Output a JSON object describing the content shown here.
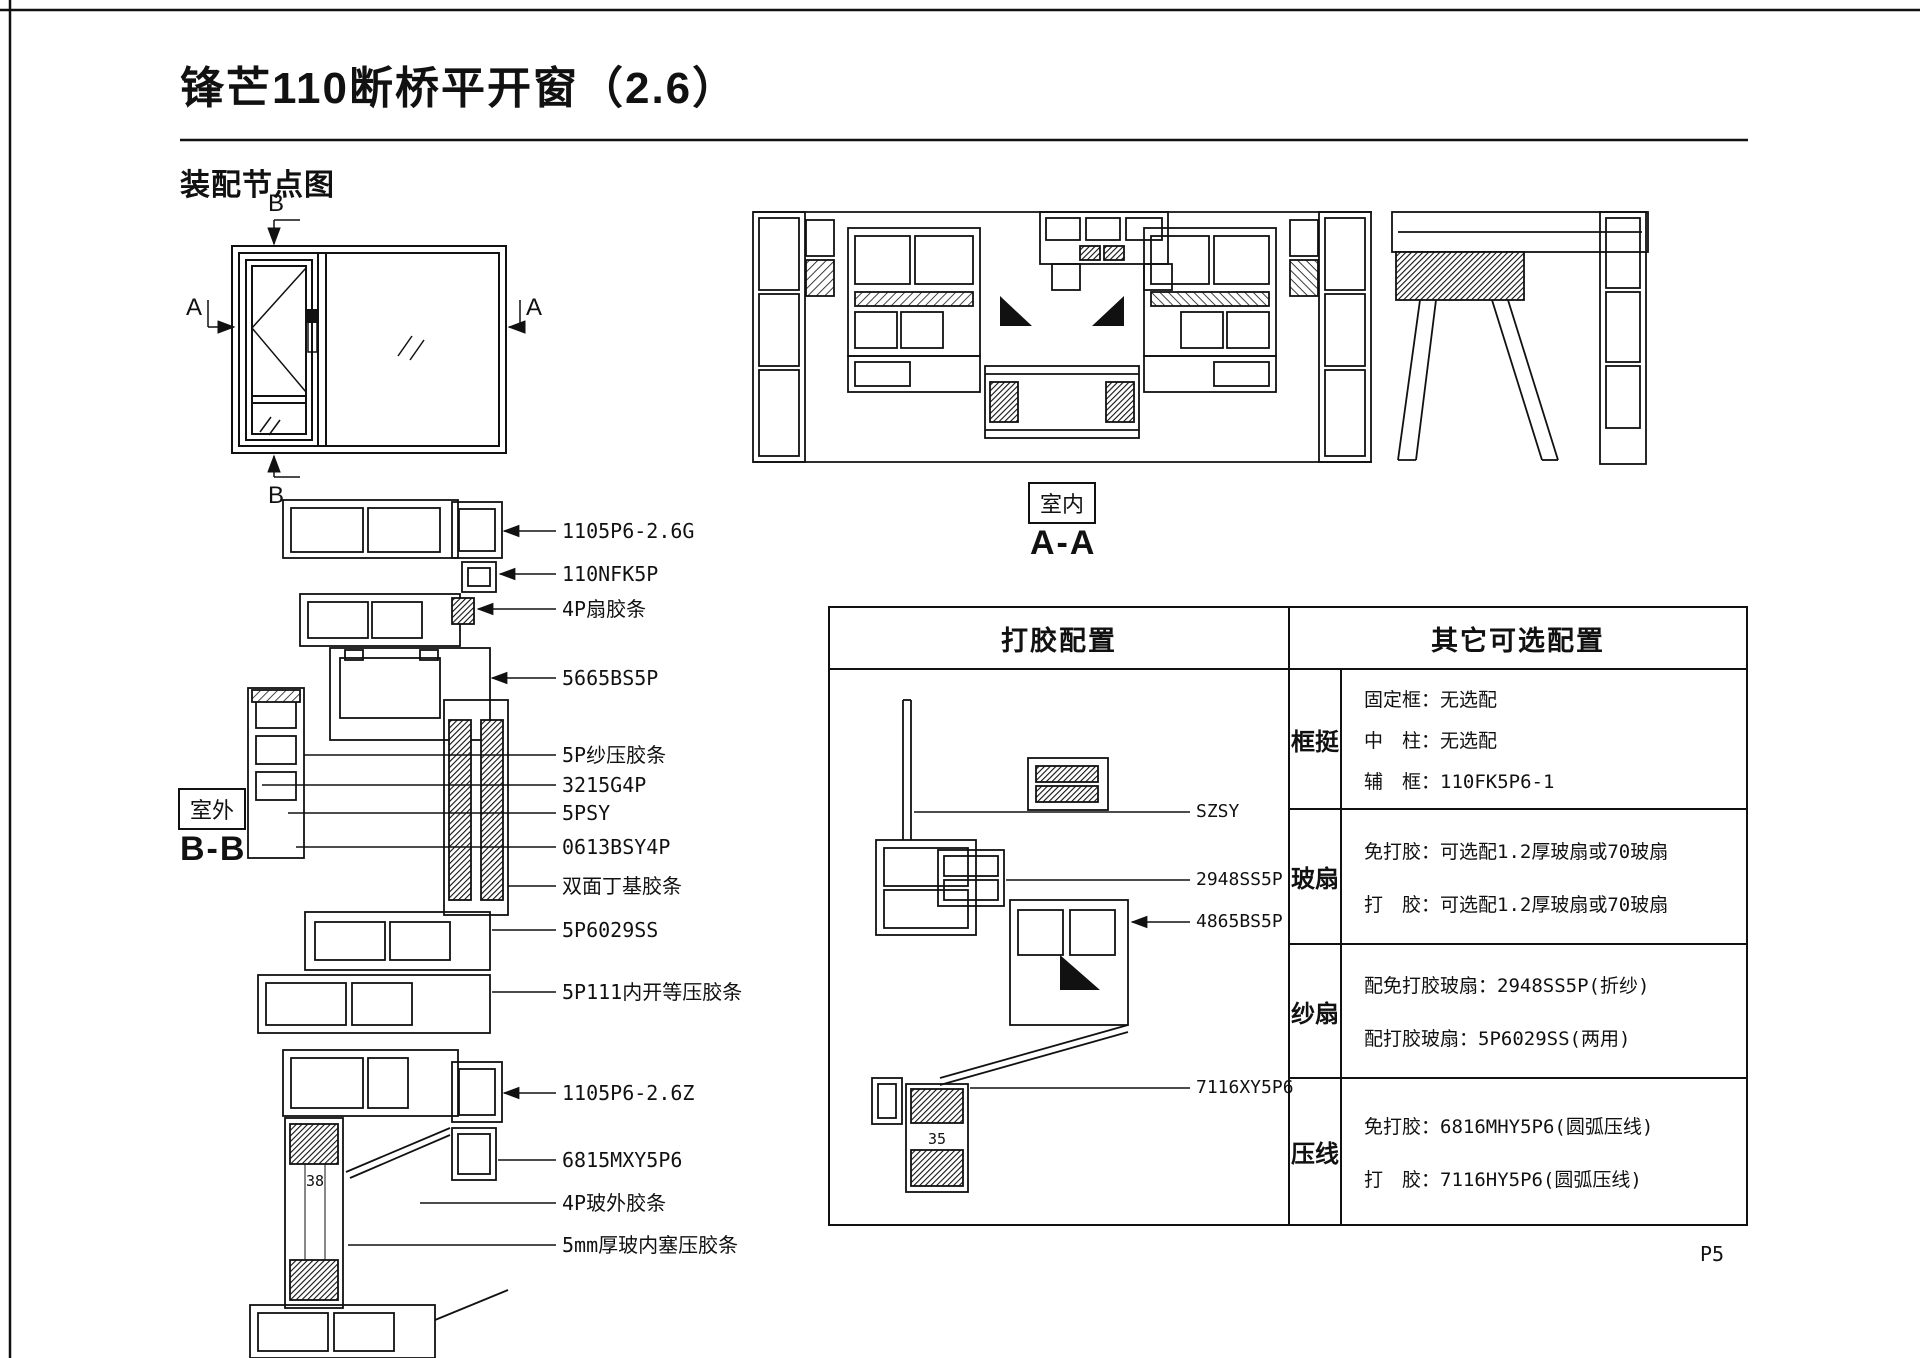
{
  "page": {
    "title": "锋芒110断桥平开窗（2.6）",
    "subtitle": "装配节点图",
    "page_number": "P5"
  },
  "elevation": {
    "marker_top": "B",
    "marker_bottom": "B",
    "marker_left": "A",
    "marker_right": "A"
  },
  "aa": {
    "room_label": "室内",
    "section_name": "A-A"
  },
  "bb": {
    "room_label": "室外",
    "section_name": "B-B",
    "glass_dimension": "38",
    "callouts": [
      {
        "label": "1105P6-2.6G"
      },
      {
        "label": "110NFK5P"
      },
      {
        "label": "4P扇胶条"
      },
      {
        "label": "5665BS5P"
      },
      {
        "label": "5P纱压胶条"
      },
      {
        "label": "3215G4P"
      },
      {
        "label": "5PSY"
      },
      {
        "label": "0613BSY4P"
      },
      {
        "label": "双面丁基胶条"
      },
      {
        "label": "5P6029SS"
      },
      {
        "label": "5P111内开等压胶条"
      },
      {
        "label": "1105P6-2.6Z"
      },
      {
        "label": "6815MXY5P6"
      },
      {
        "label": "4P玻外胶条"
      },
      {
        "label": "5mm厚玻内塞压胶条"
      }
    ]
  },
  "table": {
    "glue_header": "打胶配置",
    "optional_header": "其它可选配置",
    "diagram": {
      "callouts": [
        {
          "label": "SZSY"
        },
        {
          "label": "2948SS5P"
        },
        {
          "label": "4865BS5P"
        },
        {
          "label": "7116XY5P6"
        }
      ],
      "dimension": "35"
    },
    "rows": [
      {
        "category": "框挺",
        "lines": [
          "固定框：无选配",
          "中　柱：无选配",
          "辅　框：110FK5P6-1"
        ]
      },
      {
        "category": "玻扇",
        "lines": [
          "免打胶：可选配1.2厚玻扇或70玻扇",
          "打　胶：可选配1.2厚玻扇或70玻扇"
        ]
      },
      {
        "category": "纱扇",
        "lines": [
          "配免打胶玻扇：2948SS5P(折纱)",
          "配打胶玻扇：5P6029SS(两用)"
        ]
      },
      {
        "category": "压线",
        "lines": [
          "免打胶：6816MHY5P6(圆弧压线)",
          "打　胶：7116HY5P6(圆弧压线)"
        ]
      }
    ]
  }
}
